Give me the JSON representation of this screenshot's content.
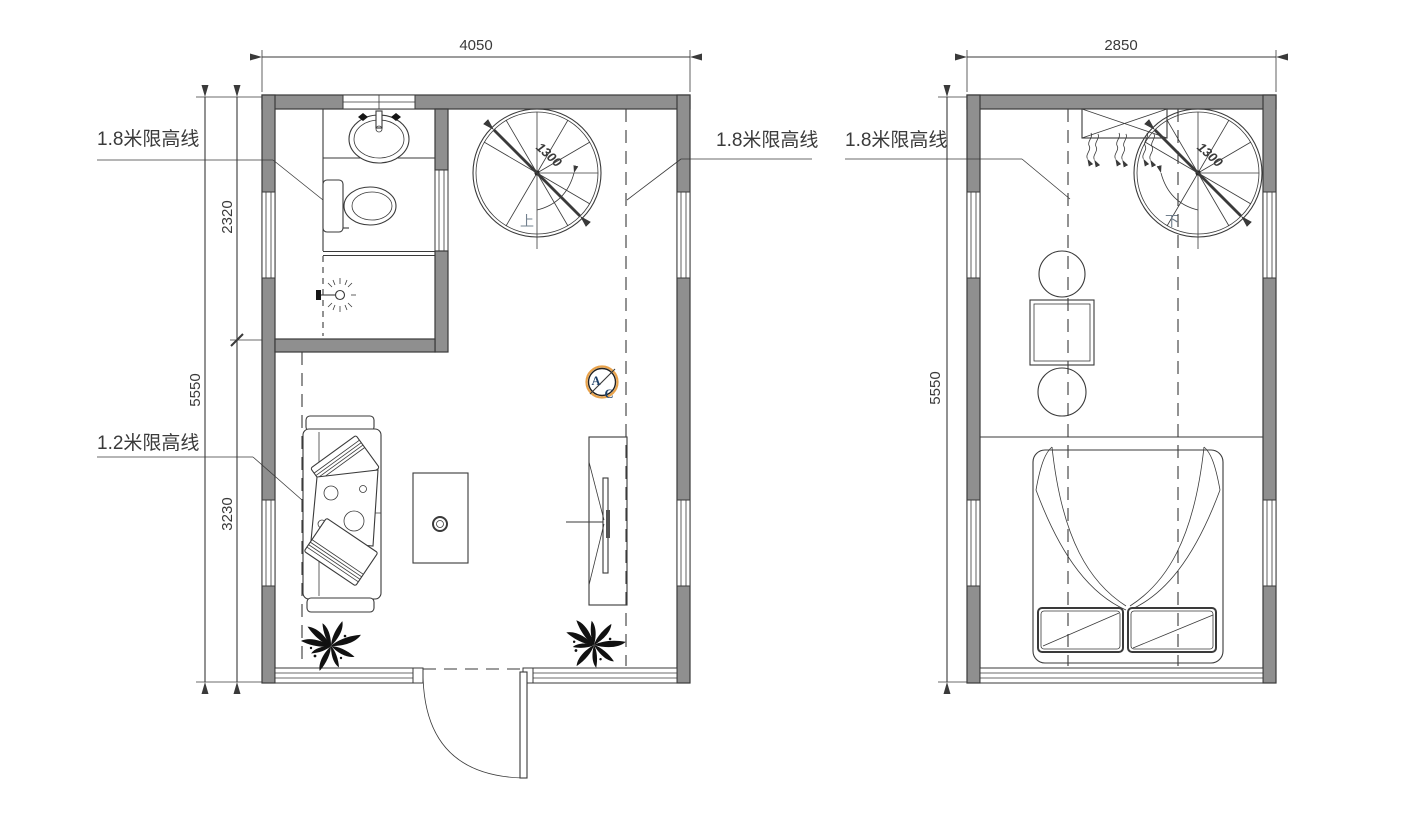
{
  "colors": {
    "line": "#3a3a3a",
    "wall": "#8f8f8f",
    "orange": "#e8a24b",
    "navy": "#1d3f66",
    "stairblue": "#72808e",
    "paper": "#ffffff"
  },
  "plans": {
    "left": {
      "width_label": "4050",
      "height_total_label": "5550",
      "height_upper_label": "2320",
      "height_lower_label": "3230",
      "limit_left_label": "1.8米限高线",
      "limit_sofa_label": "1.2米限高线",
      "limit_right_label": "1.8米限高线",
      "stair_diameter_label": "1300",
      "stair_direction_label": "上",
      "ac_letter_top": "A",
      "ac_letter_bottom": "C"
    },
    "right": {
      "width_label": "2850",
      "height_total_label": "5550",
      "limit_label": "1.8米限高线",
      "stair_diameter_label": "1300",
      "stair_direction_label": "下"
    }
  }
}
